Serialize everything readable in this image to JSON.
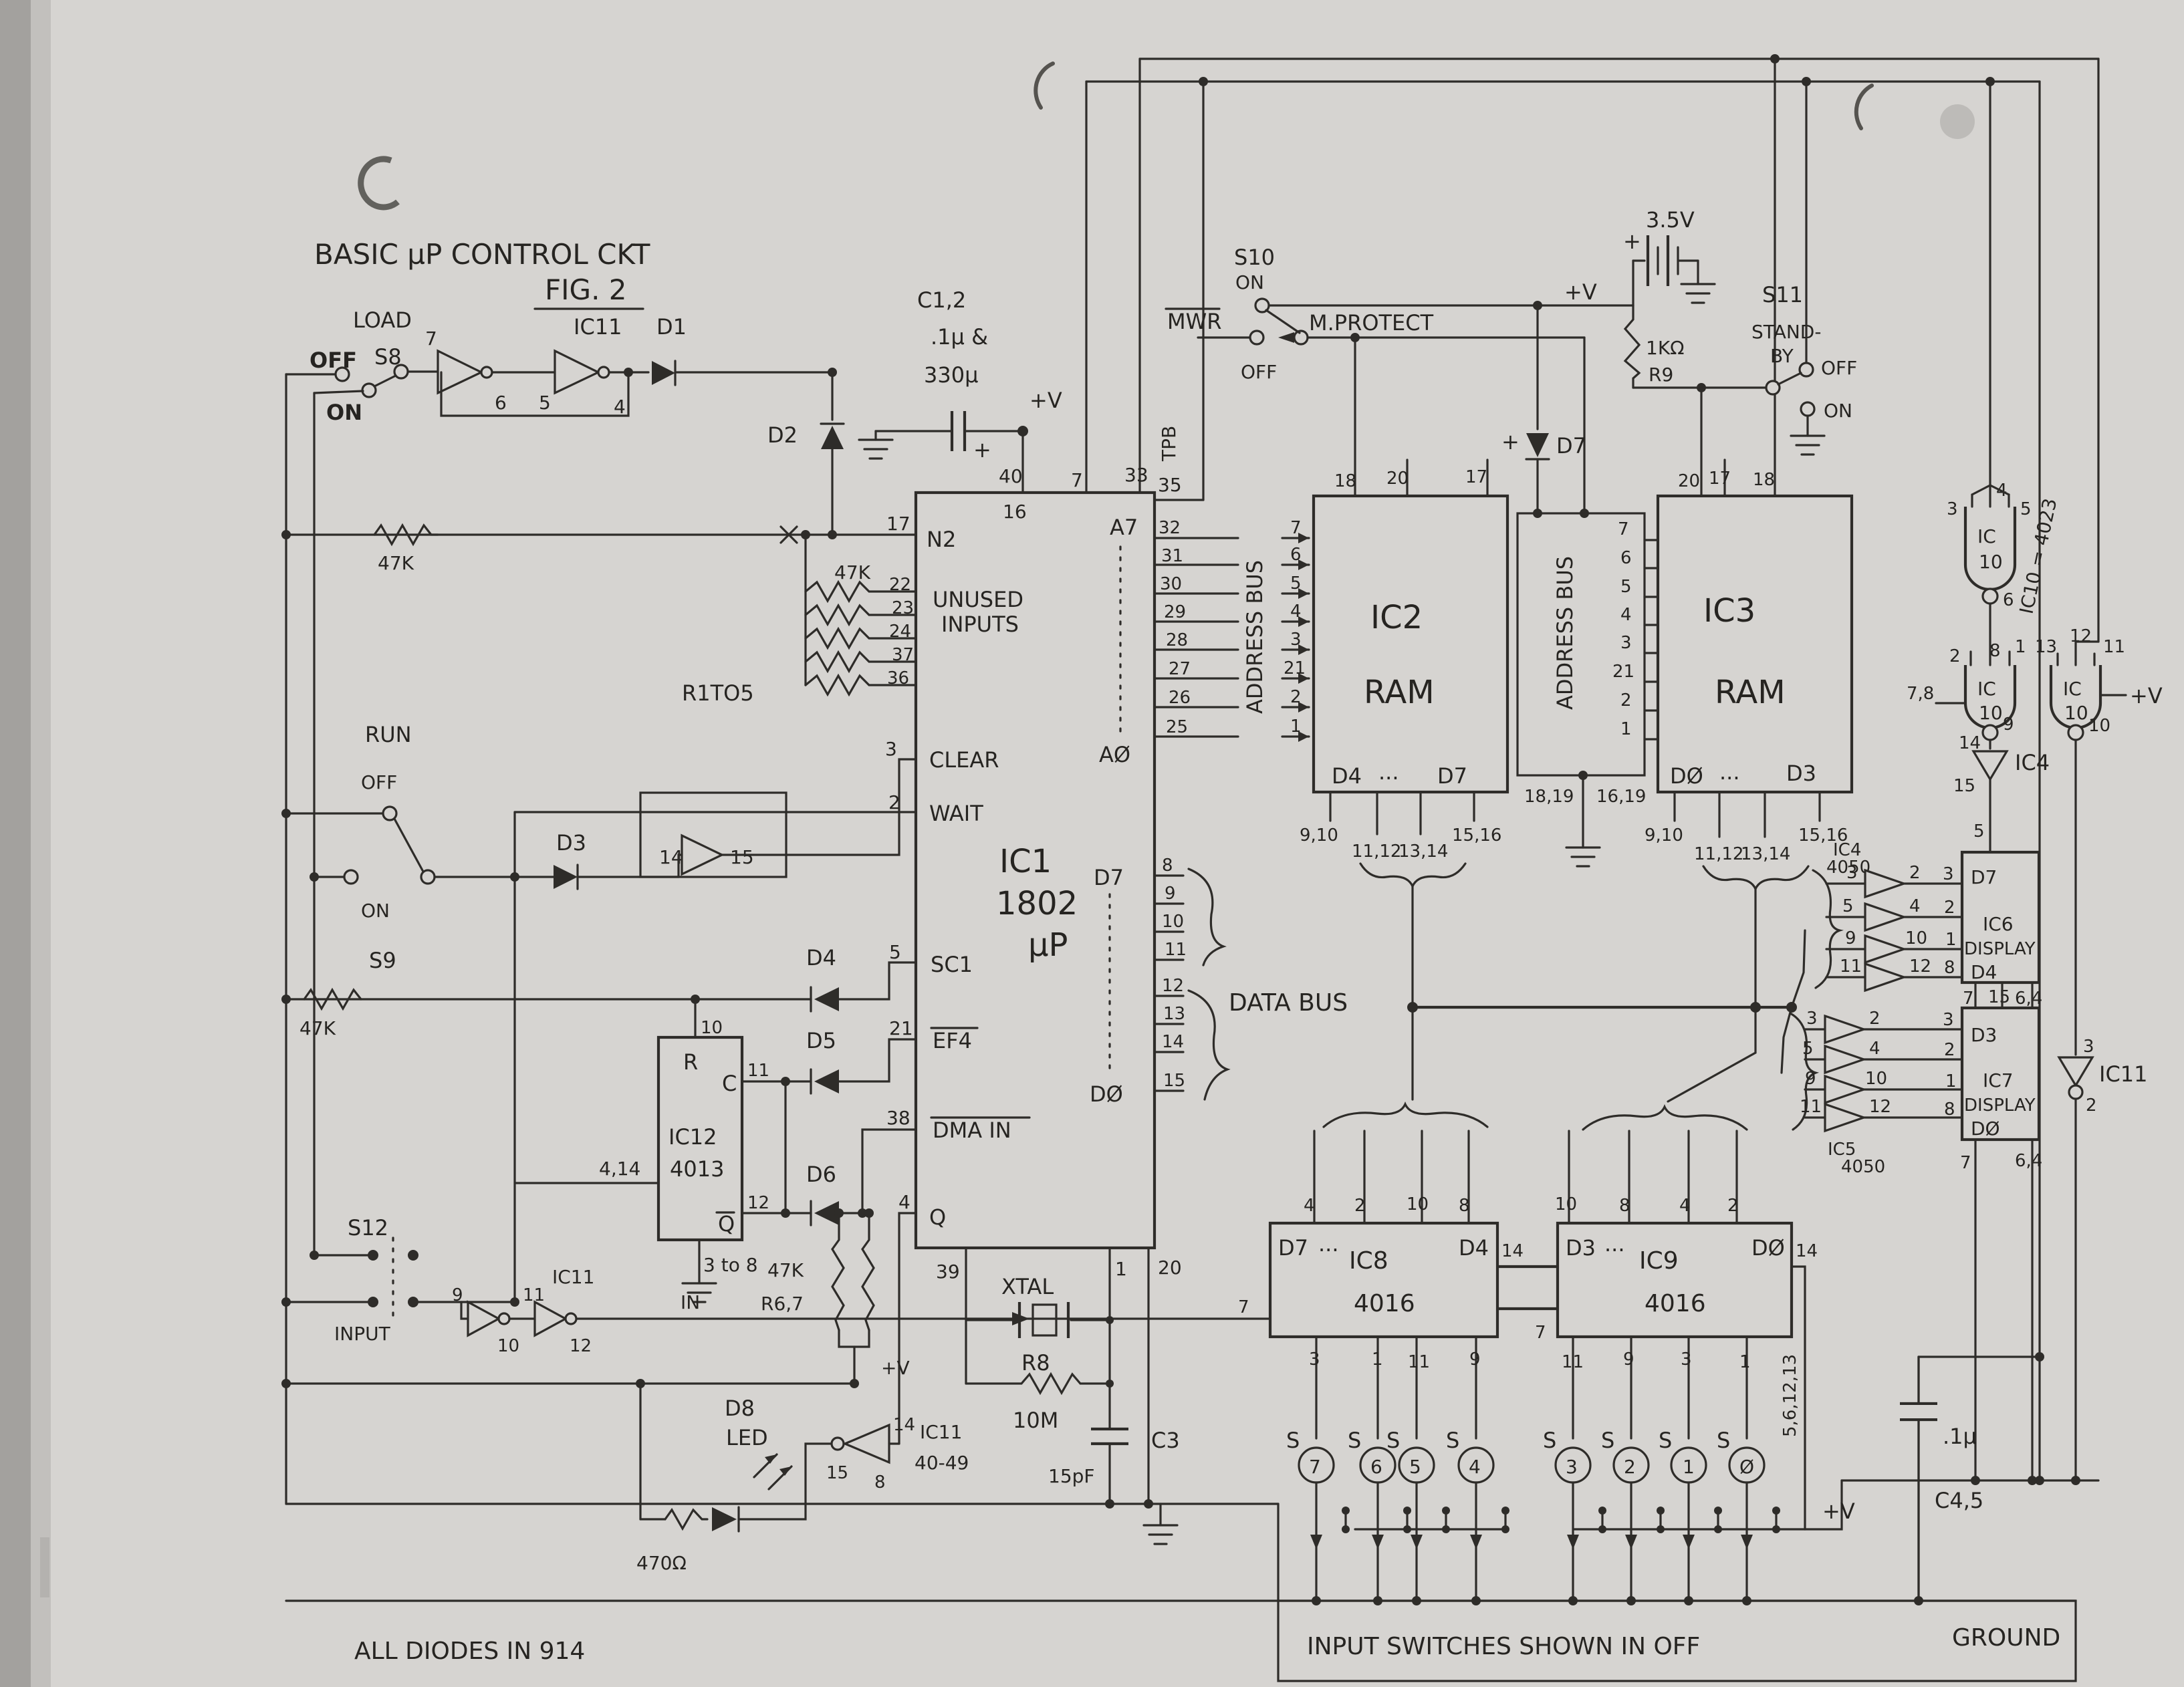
{
  "title": {
    "main": "BASIC µP CONTROL CKT",
    "fig": "FIG. 2"
  },
  "load": {
    "label": "LOAD",
    "off": "OFF",
    "name": "S8",
    "on": "ON",
    "p7": "7",
    "p6": "6",
    "ic": "IC11",
    "p5": "5",
    "p4": "4"
  },
  "run": {
    "label": "RUN",
    "off": "OFF",
    "on": "ON",
    "name": "S9",
    "p14": "14",
    "p15": "15"
  },
  "s10": {
    "name": "S10",
    "on": "ON",
    "off": "OFF"
  },
  "s11": {
    "name": "S11",
    "l1": "STAND-",
    "l2": "BY",
    "off": "OFF",
    "on": "ON"
  },
  "s12": {
    "name": "S12",
    "input": "INPUT"
  },
  "sig": {
    "mwr": "MWR",
    "mprotect": "M.PROTECT",
    "databus": "DATA BUS",
    "addressbus": "ADDRESS BUS",
    "in": "IN",
    "pv": "+V",
    "ground": "GROUND",
    "tpb": "TPB"
  },
  "power": {
    "battery": "3.5V",
    "plus": "+",
    "c12name": "C1,2",
    "c12a": ".1µ &",
    "c12b": "330µ",
    "r9val": "1KΩ",
    "r9": "R9",
    "c45": "C4,5",
    "c45v": ".1µ",
    "c3": "C3",
    "c3v": "15pF"
  },
  "res": {
    "r47k": "47K",
    "r1to5": "R1TO5",
    "r67": "R6,7",
    "r470": "470Ω",
    "r8": "R8",
    "r8v": "10M"
  },
  "diodes": {
    "d1": "D1",
    "d2": "D2",
    "d3": "D3",
    "d4": "D4",
    "d5": "D5",
    "d6": "D6",
    "d7": "D7",
    "d8": "D8",
    "led": "LED"
  },
  "ic1": {
    "name": "IC1",
    "part": "1802",
    "sub": "µP",
    "p40": "40",
    "p16": "16",
    "p7": "7",
    "p33": "33",
    "p35": "35",
    "p17": "17",
    "n2": "N2",
    "p22": "22",
    "p23": "23",
    "p24": "24",
    "p37": "37",
    "p36": "36",
    "unused1": "UNUSED",
    "unused2": "INPUTS",
    "p3": "3",
    "clear": "CLEAR",
    "p2": "2",
    "wait": "WAIT",
    "p5": "5",
    "sc1": "SC1",
    "p21": "21",
    "ef4": "EF4",
    "p38": "38",
    "dmain": "DMA IN",
    "p4": "4",
    "q": "Q",
    "a7": "A7",
    "a0": "AØ",
    "addr": [
      "32",
      "31",
      "30",
      "29",
      "28",
      "27",
      "26",
      "25"
    ],
    "d7": "D7",
    "d0": "DØ",
    "data": [
      "8",
      "9",
      "10",
      "11",
      "12",
      "13",
      "14",
      "15"
    ],
    "p39": "39",
    "p1": "1",
    "p20": "20"
  },
  "abusL": {
    "pins": [
      "7",
      "6",
      "5",
      "4",
      "3",
      "21",
      "2",
      "1"
    ]
  },
  "ic2": {
    "name": "IC2",
    "type": "RAM",
    "dl": "D4",
    "dots": "...",
    "dr": "D7",
    "t0": "18",
    "t1": "20",
    "t2": "17",
    "b": [
      "9,10",
      "11,12",
      "13,14",
      "15,16"
    ]
  },
  "chan": {
    "p7": "7",
    "pins": [
      "6",
      "5",
      "4",
      "3",
      "21",
      "2",
      "1"
    ],
    "bl": "18,19",
    "br": "16,19"
  },
  "ic3": {
    "name": "IC3",
    "type": "RAM",
    "dl": "DØ",
    "dots": "...",
    "dr": "D3",
    "t0": "20",
    "t1": "17",
    "t2": "18",
    "b": [
      "9,10",
      "11,12",
      "13,14",
      "15,16"
    ]
  },
  "ic8": {
    "name": "IC8",
    "part": "4016",
    "dl": "D7",
    "dots": "...",
    "dr": "D4",
    "p14": "14",
    "p7": "7",
    "top": [
      "4",
      "2",
      "10",
      "8"
    ],
    "bot": [
      "3",
      "1",
      "11",
      "9"
    ]
  },
  "ic9": {
    "name": "IC9",
    "part": "4016",
    "dl": "D3",
    "dots": "...",
    "dr": "DØ",
    "p14": "14",
    "p7": "7",
    "top": [
      "10",
      "8",
      "4",
      "2"
    ],
    "bot": [
      "11",
      "9",
      "3",
      "1"
    ],
    "ctl": "5,6,12,13"
  },
  "sw": {
    "s": "S",
    "d": [
      "7",
      "6",
      "5",
      "4",
      "3",
      "2",
      "1",
      "Ø"
    ]
  },
  "ic10": {
    "ic": "IC",
    "ten": "10",
    "eq": "IC10 = 4023",
    "g1in": [
      "3",
      "4",
      "5"
    ],
    "g1out": "6",
    "g2in": [
      "2",
      "8",
      "1"
    ],
    "g2side": "7,8",
    "g2out": "9",
    "g3in": [
      "13",
      "12",
      "11"
    ],
    "g3out": "10"
  },
  "ic4inv": {
    "p14": "14",
    "name": "IC4",
    "p15": "15",
    "p5": "5"
  },
  "ic11g": {
    "p3": "3",
    "name": "IC11",
    "p2": "2"
  },
  "ic4": {
    "name": "IC4",
    "part": "4050",
    "in": [
      "3",
      "5",
      "9",
      "11"
    ],
    "out": [
      "2",
      "4",
      "10",
      "12"
    ],
    "pins": [
      "3",
      "2",
      "1",
      "8"
    ]
  },
  "ic5": {
    "name": "IC5",
    "part": "4050",
    "in": [
      "3",
      "5",
      "9",
      "11"
    ],
    "out": [
      "2",
      "4",
      "10",
      "12"
    ],
    "pins": [
      "3",
      "2",
      "1",
      "8"
    ]
  },
  "ic6": {
    "name": "IC6",
    "type": "DISPLAY",
    "dt": "D7",
    "db": "D4",
    "p5": "5",
    "b0": "7",
    "b1": "15",
    "b2": "6,4"
  },
  "ic7": {
    "name": "IC7",
    "type": "DISPLAY",
    "dt": "D3",
    "db": "DØ",
    "b0": "7",
    "b2": "6,4"
  },
  "ic12": {
    "name": "IC12",
    "part": "4013",
    "r": "R",
    "c": "C",
    "qb": "Q",
    "p10": "10",
    "p11": "11",
    "p12": "12",
    "left": "4,14",
    "bot": "3 to 8"
  },
  "ic11led": {
    "p14": "14",
    "p15": "15",
    "p8": "8",
    "name": "IC11",
    "part": "40-49"
  },
  "ic11in": {
    "name": "IC11",
    "p9": "9",
    "p10": "10",
    "p11": "11",
    "p12": "12"
  },
  "xtal": {
    "label": "XTAL"
  },
  "notes": {
    "diodes": "ALL DIODES IN 914",
    "sw": "INPUT SWITCHES SHOWN IN OFF"
  }
}
